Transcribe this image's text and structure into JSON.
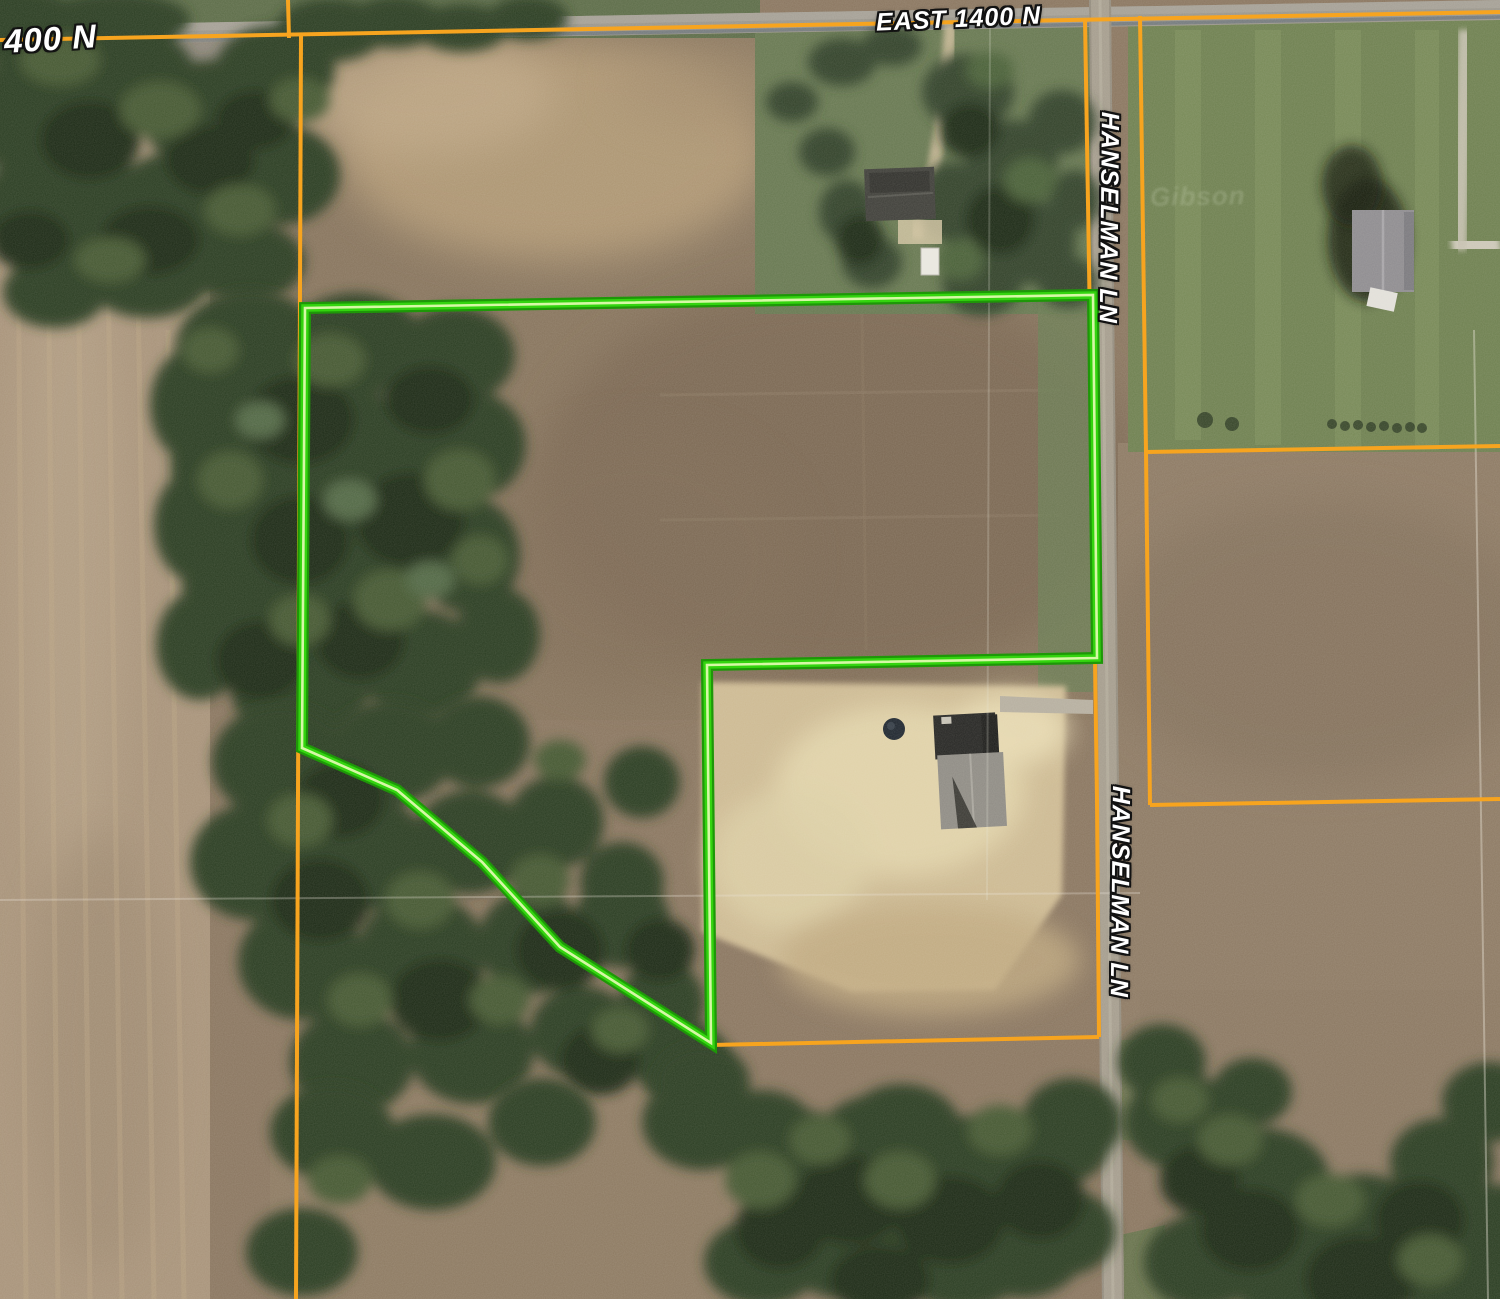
{
  "map": {
    "labels": {
      "road_400n": "400 N",
      "road_east_1400n": "EAST 1400 N",
      "hanselman_lane_upper": "HANSELMAN LN",
      "hanselman_lane_lower": "HANSELMAN LN",
      "ghost_text": "Gibson"
    },
    "parcel_boundary": {
      "points": "305,308 1093,295 1097,658 707,665 711,1043 560,947 482,862 397,790 302,748",
      "color_outer": "#1e9708",
      "color_main": "#33d40f",
      "color_core": "#d6f8a6"
    },
    "parcel_lines": {
      "color": "#f7a41f",
      "segments": [
        "0,40 1500,12",
        "288,0 289,38",
        "301,36 296,1299",
        "1085,18 1092,450 1097,800 1099,1037",
        "1140,16 1146,452 1150,805",
        "1146,452 1500,446",
        "1150,805 1500,799",
        "711,1045 1099,1037"
      ]
    },
    "section_lines": {
      "color": "#eae6da",
      "segments": [
        "0,900 1140,893",
        "990,22 987,900",
        "1474,330 1488,1299"
      ]
    }
  }
}
